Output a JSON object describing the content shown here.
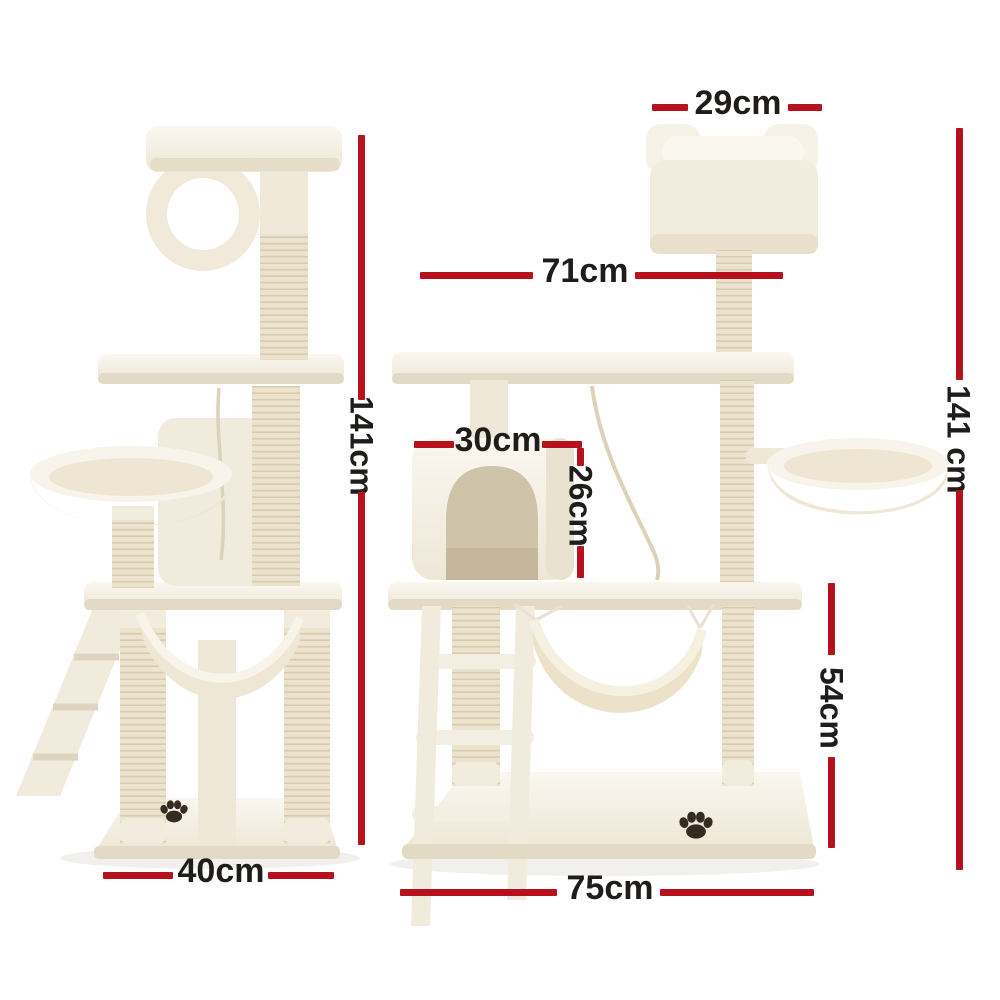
{
  "colors": {
    "dimension_line": "#b5121d",
    "label_text": "#1f1d1a",
    "background": "#ffffff",
    "fur_light": "#f7f3ea",
    "fur_shadow": "#e3dac6",
    "sisal": "#ece3ce",
    "paw_print": "#362b20"
  },
  "labels": {
    "top_box_width": "29cm",
    "upper_platform_width": "71cm",
    "total_height_side": "141cm",
    "total_height_front": "141 cm",
    "condo_width": "30cm",
    "condo_height": "26cm",
    "lower_section_height": "54cm",
    "base_depth": "40cm",
    "base_width": "75cm"
  }
}
